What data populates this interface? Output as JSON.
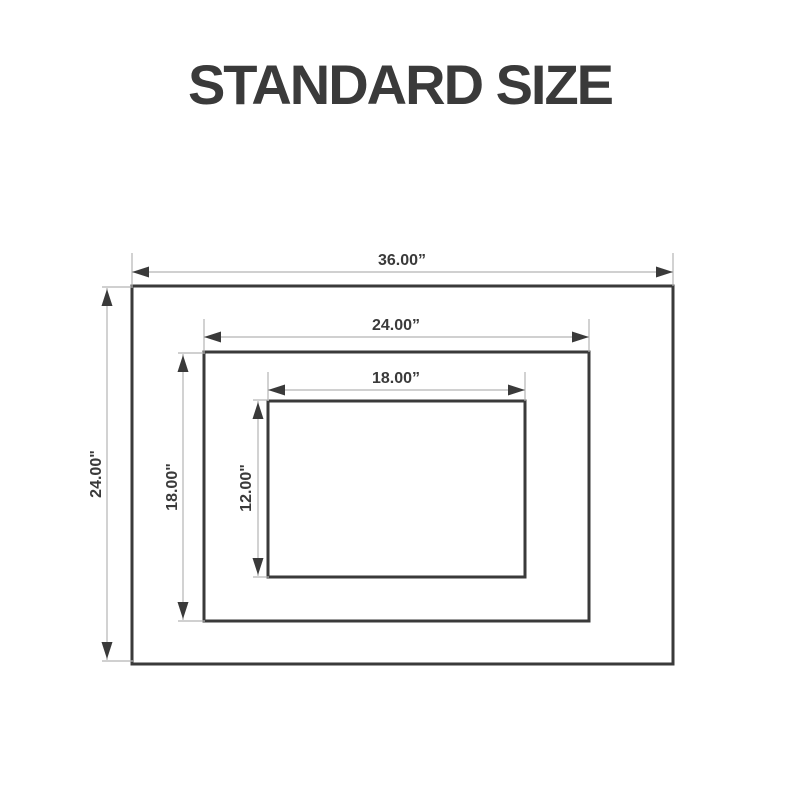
{
  "title": "STANDARD SIZE",
  "colors": {
    "ink": "#3a3a3a",
    "dimension_line": "#b4b4b4",
    "background": "#ffffff"
  },
  "labels": {
    "outer_width": "36.00”",
    "outer_height": "24.00\"",
    "middle_width": "24.00”",
    "middle_height": "18.00\"",
    "inner_width": "18.00”",
    "inner_height": "12.00\""
  },
  "sizes": [
    {
      "name": "outer",
      "width_inches": "36.00",
      "height_inches": "24.00"
    },
    {
      "name": "middle",
      "width_inches": "24.00",
      "height_inches": "18.00"
    },
    {
      "name": "inner",
      "width_inches": "18.00",
      "height_inches": "12.00"
    }
  ]
}
